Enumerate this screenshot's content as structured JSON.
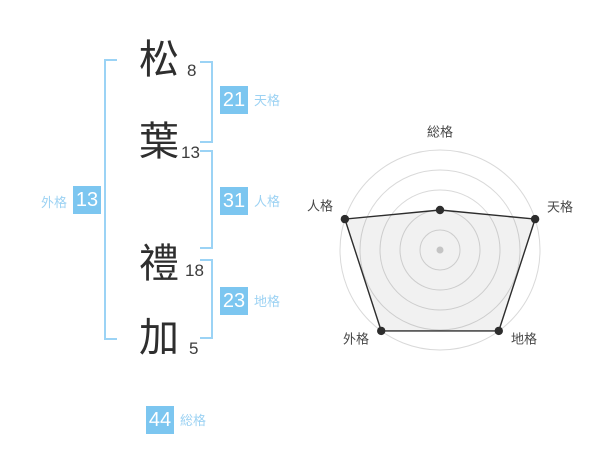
{
  "name": {
    "characters": [
      {
        "char": "松",
        "strokes": "8"
      },
      {
        "char": "葉",
        "strokes": "13"
      },
      {
        "char": "禮",
        "strokes": "18"
      },
      {
        "char": "加",
        "strokes": "5"
      }
    ]
  },
  "gokaku": {
    "tenkaku": {
      "label": "天格",
      "value": "21"
    },
    "jinkaku": {
      "label": "人格",
      "value": "31"
    },
    "chikaku": {
      "label": "地格",
      "value": "23"
    },
    "gaikaku": {
      "label": "外格",
      "value": "13"
    },
    "soukaku": {
      "label": "総格",
      "value": "44"
    }
  },
  "colors": {
    "badge_blue": "#7cc6f0",
    "label_blue": "#9cd2f3",
    "bracket_blue": "#9bd3f5",
    "kanji_dark": "#2e2e2e",
    "ring_gray": "#d9d9d9",
    "polygon_stroke": "#2d2d2d",
    "polygon_fill": "rgba(0,0,0,0.055)",
    "center_dot_gray": "#c4c4c4",
    "radar_label_gray": "#474747"
  },
  "chart_data": {
    "type": "radar",
    "categories": [
      "総格",
      "天格",
      "地格",
      "外格",
      "人格"
    ],
    "values": [
      2,
      5,
      5,
      5,
      5
    ],
    "max": 5,
    "rings": 5,
    "angles_deg": [
      90,
      18,
      306,
      234,
      162
    ],
    "grid": "concentric-circles",
    "legend": "none",
    "title": ""
  }
}
